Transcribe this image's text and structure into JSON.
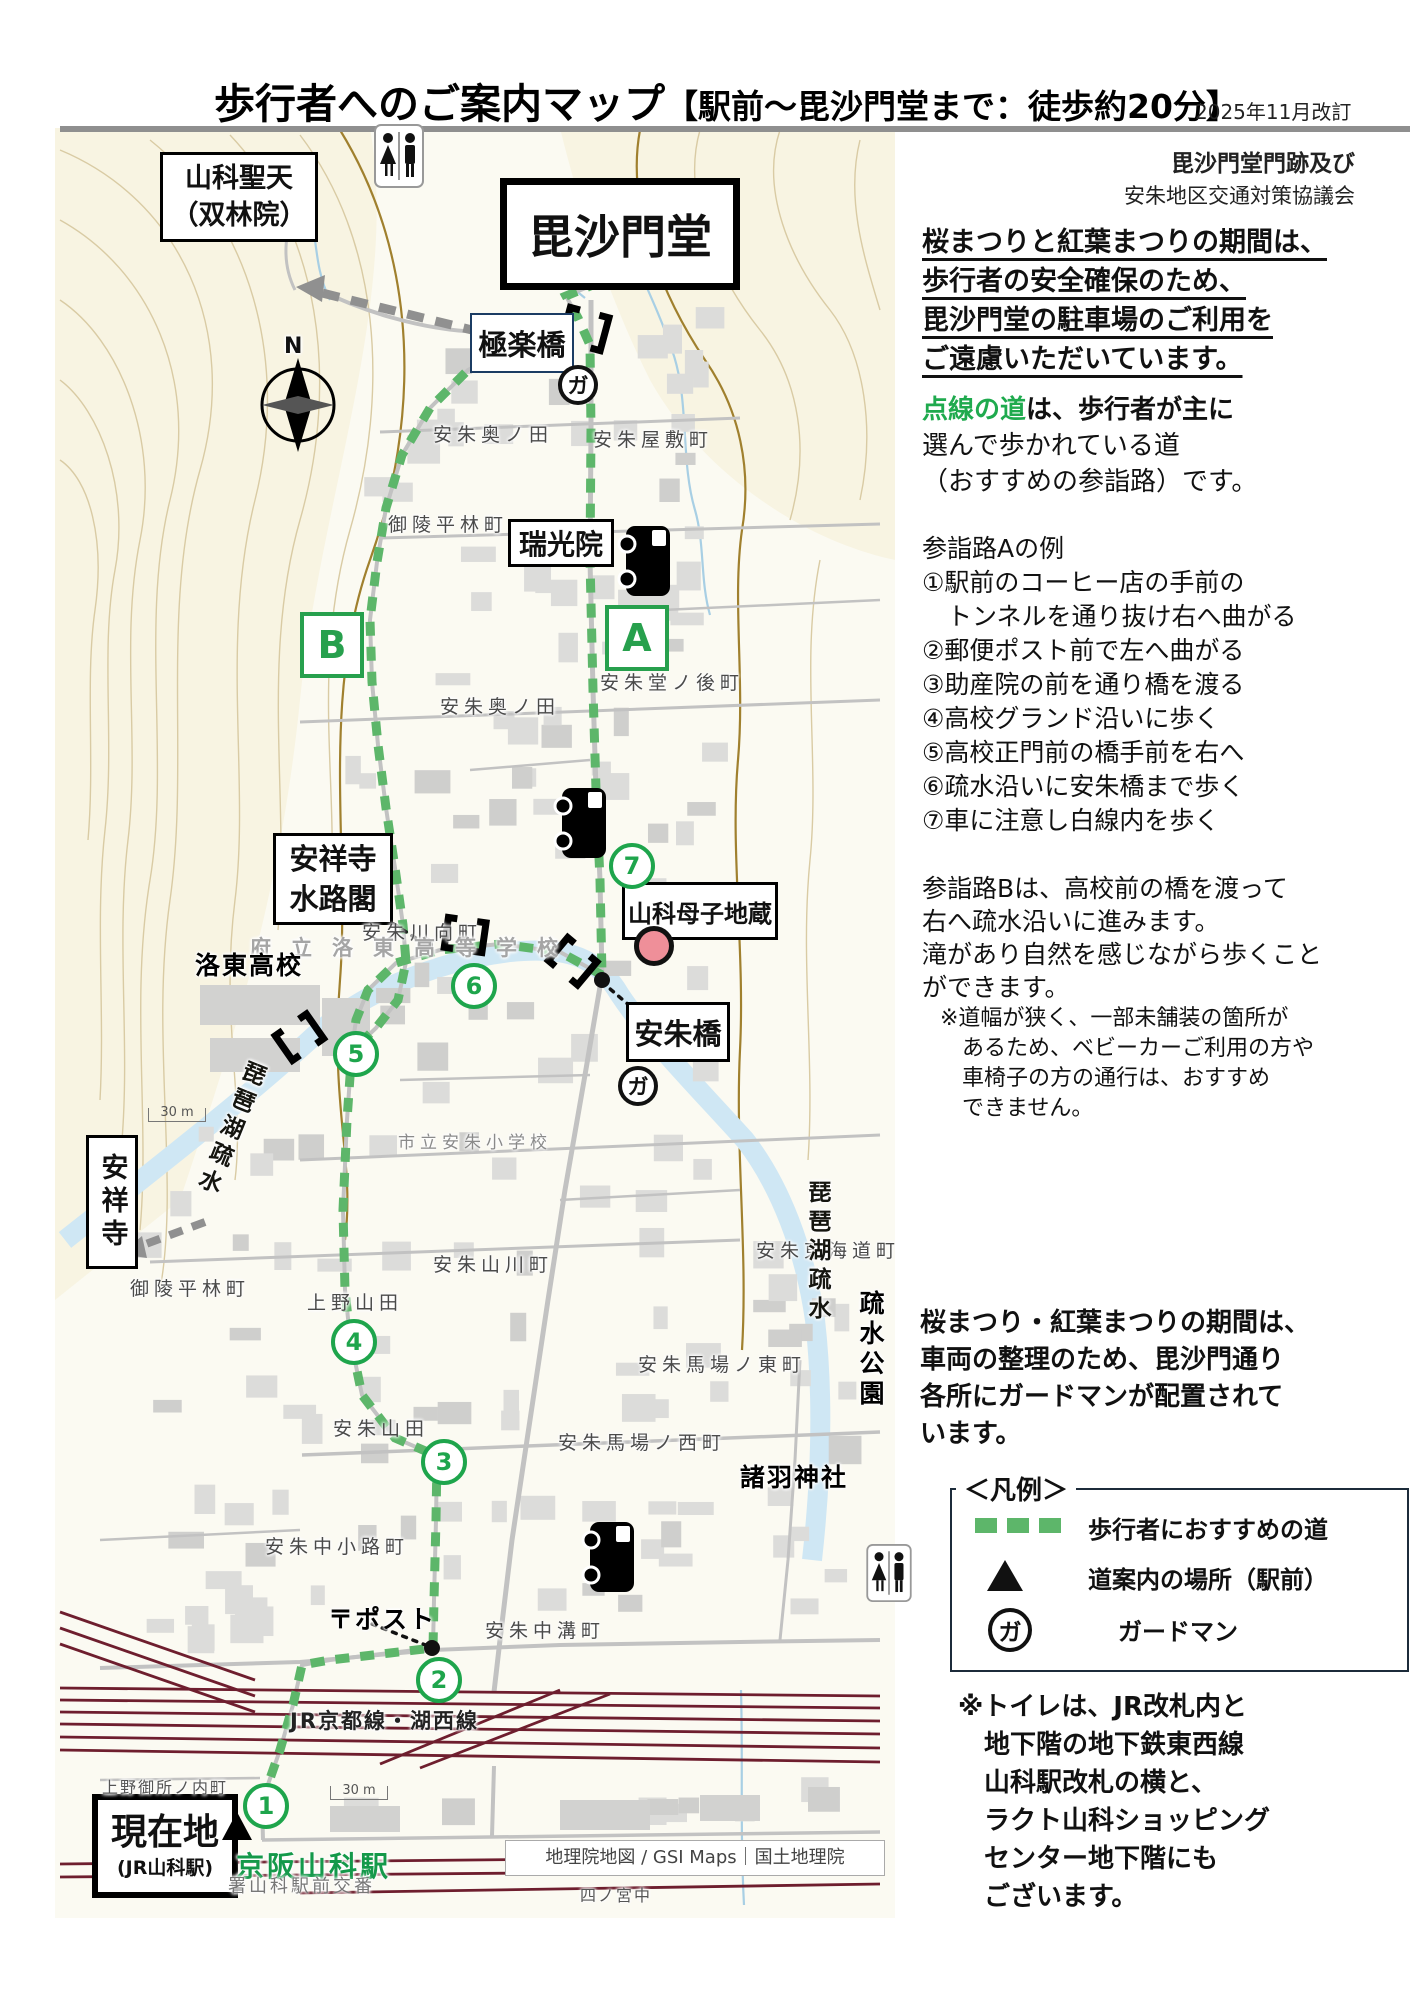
{
  "header": {
    "title_main": "歩行者へのご案内マップ",
    "title_sub": "【駅前〜毘沙門堂まで：徒歩約20分】",
    "revision": "2025年11月改訂",
    "org_line1": "毘沙門堂門跡及び",
    "org_line2": "安朱地区交通対策協議会"
  },
  "sidebar": {
    "notice_lines": [
      "桜まつりと紅葉まつりの期間は、",
      "歩行者の安全確保のため、",
      "毘沙門堂の駐車場のご利用を",
      "ご遠慮いただいています。"
    ],
    "dotted_lead": "点線の道",
    "dotted_rest": "は、歩行者が主に",
    "dotted_lines": "選んで歩かれている道\n（おすすめの参詣路）です。",
    "routeA_text": "参詣路Aの例\n①駅前のコーヒー店の手前の\n　トンネルを通り抜け右へ曲がる\n②郵便ポスト前で左へ曲がる\n③助産院の前を通り橋を渡る\n④高校グランド沿いに歩く\n⑤高校正門前の橋手前を右へ\n⑥疏水沿いに安朱橋まで歩く\n⑦車に注意し白線内を歩く",
    "routeB_text": "参詣路Bは、高校前の橋を渡って\n右へ疏水沿いに進みます。\n滝があり自然を感じながら歩くこと\nができます。",
    "walk_note": "※道幅が狭く、一部未舗装の箇所が\n　あるため、ベビーカーご利用の方や\n　車椅子の方の通行は、おすすめ\n　できません。",
    "guard_text": "桜まつり・紅葉まつりの期間は、\n車両の整理のため、毘沙門通り\n各所にガードマンが配置されて\nいます。",
    "legend": {
      "title": "＜凡例＞",
      "item1": "歩行者におすすめの道",
      "item2": "道案内の場所（駅前）",
      "item3": "ガードマン"
    },
    "toilet_text": "※トイレは、JR改札内と\n　地下階の地下鉄東西線\n　山科駅改札の横と、\n　ラクト山科ショッピング\n　センター地下階にも\n　ございます。"
  },
  "map": {
    "boxes": {
      "yamashina_shoten": {
        "line1": "山科聖天",
        "line2": "（双林院）"
      },
      "bishamondo": "毘沙門堂",
      "gokurakubashi": "極楽橋",
      "zuikoin": "瑞光院",
      "suirokaku": {
        "line1": "安祥寺",
        "line2": "水路閣"
      },
      "boshi_jizo": "山科母子地蔵",
      "anshubashi": "安朱橋",
      "anshoji": "安祥寺",
      "genzaichi": {
        "line1": "現在地",
        "line2": "(JR山科駅)"
      }
    },
    "compass_label": "N",
    "guard_char": "ガ",
    "postbox_label": "〒ポスト",
    "rail_label": "JR京都線・湖西線",
    "station_name": "京阪山科駅",
    "credit": "地理院地図 / GSI Maps｜国土地理院",
    "scale_label": "30 m",
    "route_markers": [
      {
        "n": "1",
        "x": 262,
        "y": 1802
      },
      {
        "n": "2",
        "x": 435,
        "y": 1676
      },
      {
        "n": "3",
        "x": 440,
        "y": 1458
      },
      {
        "n": "4",
        "x": 350,
        "y": 1338
      },
      {
        "n": "5",
        "x": 352,
        "y": 1050
      },
      {
        "n": "6",
        "x": 470,
        "y": 982
      },
      {
        "n": "7",
        "x": 628,
        "y": 862
      }
    ],
    "letter_markers": [
      {
        "t": "A",
        "x": 605,
        "y": 605
      },
      {
        "t": "B",
        "x": 300,
        "y": 612
      }
    ],
    "guard_markers": [
      {
        "x": 577,
        "y": 384
      },
      {
        "x": 637,
        "y": 1085
      }
    ],
    "labels": [
      {
        "t": "安朱奥ノ田",
        "x": 433,
        "y": 420,
        "cls": "town"
      },
      {
        "t": "安朱屋敷町",
        "x": 593,
        "y": 425,
        "cls": "town"
      },
      {
        "t": "御陵平林町",
        "x": 388,
        "y": 510,
        "cls": "town"
      },
      {
        "t": "安朱堂ノ後町",
        "x": 600,
        "y": 668,
        "cls": "town"
      },
      {
        "t": "安朱奥ノ田",
        "x": 440,
        "y": 692,
        "cls": "town"
      },
      {
        "t": "安朱川向町",
        "x": 362,
        "y": 918,
        "cls": "town"
      },
      {
        "t": "府立洛東高等学校",
        "x": 250,
        "y": 932,
        "cls": "school"
      },
      {
        "t": "洛東高校",
        "x": 195,
        "y": 946,
        "cls": "place"
      },
      {
        "t": "市立安朱小学校",
        "x": 398,
        "y": 1128,
        "cls": "school2"
      },
      {
        "t": "安朱山川町",
        "x": 433,
        "y": 1250,
        "cls": "town"
      },
      {
        "t": "安朱東海道町",
        "x": 756,
        "y": 1236,
        "cls": "town"
      },
      {
        "t": "安朱馬場ノ東町",
        "x": 638,
        "y": 1350,
        "cls": "town"
      },
      {
        "t": "安朱馬場ノ西町",
        "x": 558,
        "y": 1428,
        "cls": "town"
      },
      {
        "t": "諸羽神社",
        "x": 740,
        "y": 1458,
        "cls": "place"
      },
      {
        "t": "上野山田",
        "x": 307,
        "y": 1288,
        "cls": "town"
      },
      {
        "t": "御陵平林町",
        "x": 130,
        "y": 1274,
        "cls": "town"
      },
      {
        "t": "安朱山田",
        "x": 333,
        "y": 1414,
        "cls": "town"
      },
      {
        "t": "安朱中小路町",
        "x": 265,
        "y": 1532,
        "cls": "town"
      },
      {
        "t": "安朱中溝町",
        "x": 485,
        "y": 1616,
        "cls": "town"
      },
      {
        "t": "上野御所ノ内町",
        "x": 102,
        "y": 1774,
        "cls": "smalltown"
      },
      {
        "t": "四ノ宮中",
        "x": 580,
        "y": 1882,
        "cls": "smalltown"
      },
      {
        "t": "署山科駅前交番",
        "x": 228,
        "y": 1872,
        "cls": "police"
      },
      {
        "t": "琵琶湖疏水",
        "x": 212,
        "y": 1056,
        "cls": "canaltext",
        "rot": 22
      },
      {
        "t": "琵琶湖疏水",
        "x": 800,
        "y": 1180,
        "cls": "canaltext",
        "rot": 0
      },
      {
        "t": "疏水公園",
        "x": 852,
        "y": 1290,
        "cls": "parktext",
        "rot": 0
      }
    ]
  }
}
